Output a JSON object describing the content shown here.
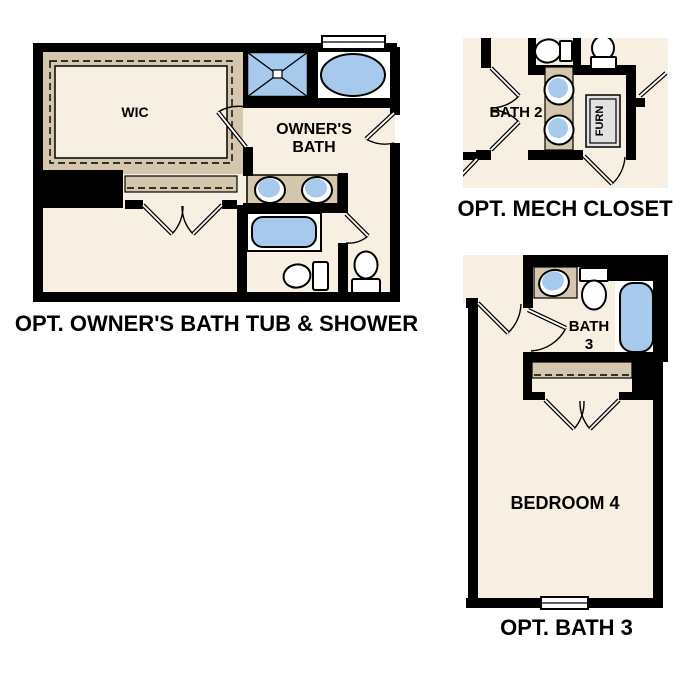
{
  "colors": {
    "floor_cream": "#f6efe2",
    "counter_tan": "#d5c7ae",
    "fixture_blue": "#a7c9eb",
    "wall_black": "#000000",
    "furnace_gray": "#e2e2e0",
    "fixture_white": "#ffffff"
  },
  "plans": {
    "owners_bath": {
      "caption": "OPT. OWNER'S BATH TUB & SHOWER",
      "wic_label": "WIC",
      "bath_label_line1": "OWNER'S",
      "bath_label_line2": "BATH"
    },
    "mech_closet": {
      "caption": "OPT. MECH CLOSET",
      "bath2_label": "BATH 2",
      "furnace_label": "FURN"
    },
    "bath3": {
      "caption": "OPT. BATH 3",
      "bath3_label_line1": "BATH",
      "bath3_label_line2": "3",
      "bedroom_label": "BEDROOM 4"
    }
  }
}
